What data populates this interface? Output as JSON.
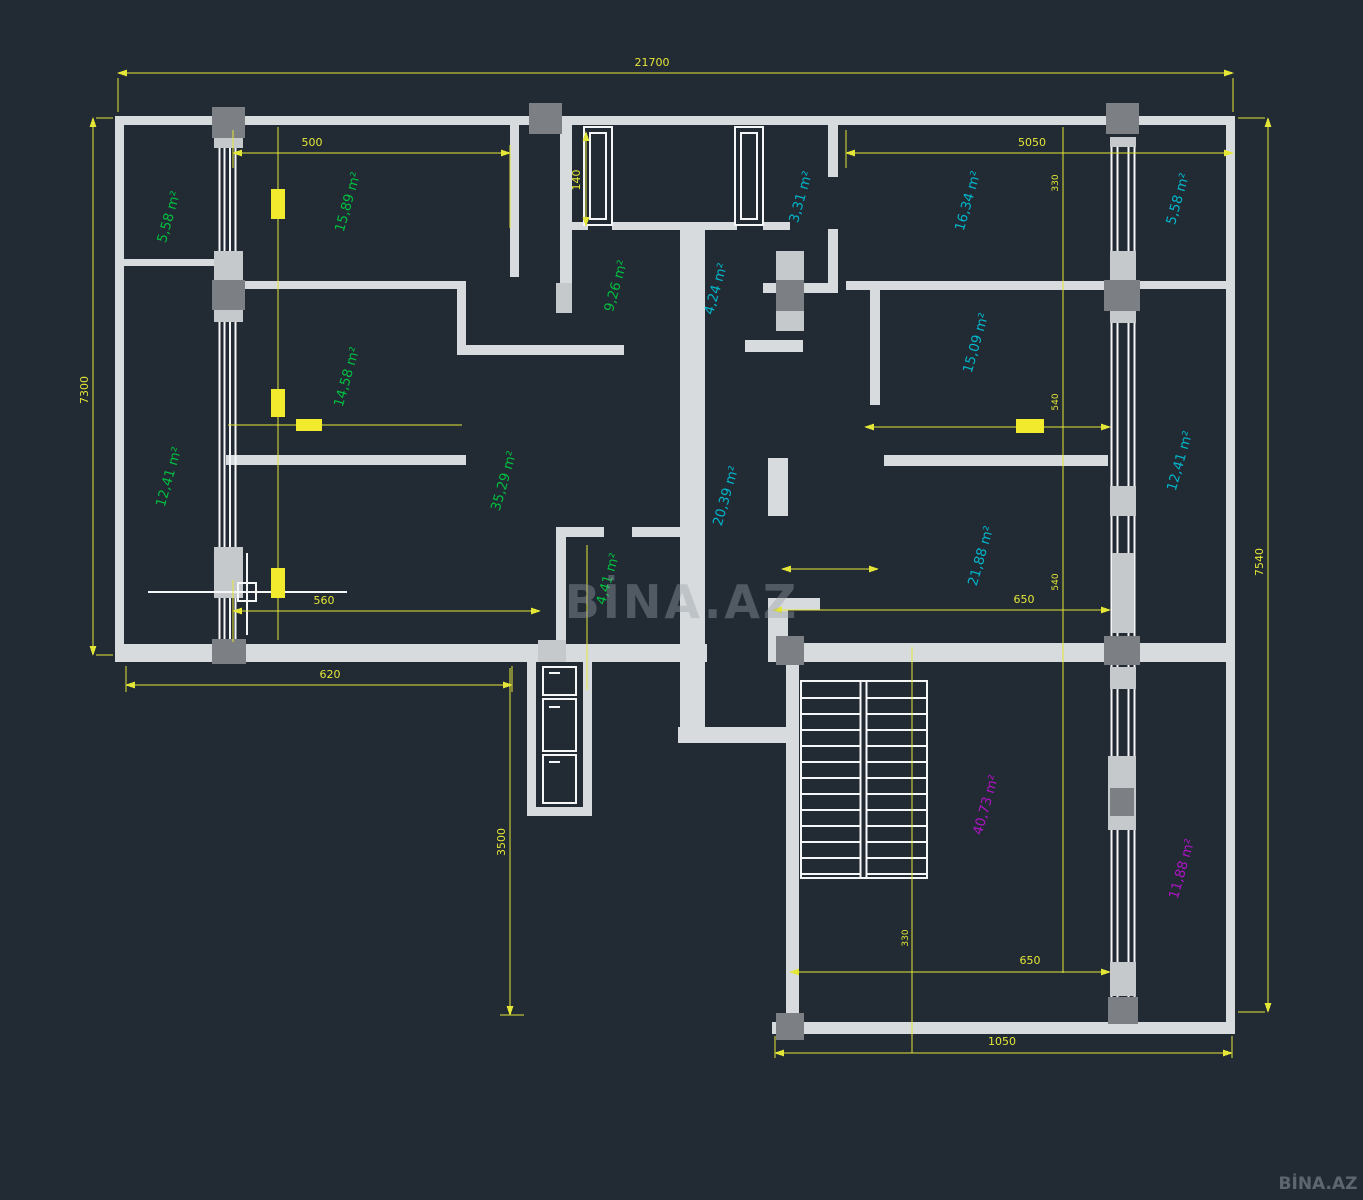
{
  "title": "Apartment floor plan (CAD drawing)",
  "colors": {
    "background": "#222a34",
    "wall": "#d8dbde",
    "wall_bright": "#f5f6f7",
    "column_dark": "#7c8085",
    "column_light": "#c6c9cc",
    "dimension": "#e4e637",
    "door": "#f2ea2c",
    "green": "#00bf3f",
    "cyan": "#00b6cb",
    "magenta": "#ae13c4",
    "watermark": "#99a0a9"
  },
  "watermark": {
    "center": "BİNA.AZ",
    "corner": "BİNA.AZ"
  },
  "rooms": [
    {
      "id": "balcony-left-top",
      "label": "5,58 m²",
      "color": "green"
    },
    {
      "id": "bedroom-left-top",
      "label": "15,89 m²",
      "color": "green"
    },
    {
      "id": "bedroom-left-mid",
      "label": "14,58 m²",
      "color": "green"
    },
    {
      "id": "balcony-left-bottom",
      "label": "12,41 m²",
      "color": "green"
    },
    {
      "id": "hall-left",
      "label": "9,26 m²",
      "color": "green"
    },
    {
      "id": "living-left",
      "label": "35,29 m²",
      "color": "green"
    },
    {
      "id": "bath-left",
      "label": "4,41 m²",
      "color": "green"
    },
    {
      "id": "vestibule",
      "label": "4,24 m²",
      "color": "cyan"
    },
    {
      "id": "wc-entry",
      "label": "3,31 m²",
      "color": "cyan"
    },
    {
      "id": "bedroom-right-top",
      "label": "16,34 m²",
      "color": "cyan"
    },
    {
      "id": "balcony-right-top",
      "label": "5,58 m²",
      "color": "cyan"
    },
    {
      "id": "bedroom-right-mid",
      "label": "15,09 m²",
      "color": "cyan"
    },
    {
      "id": "balcony-right-mid",
      "label": "12,41 m²",
      "color": "cyan"
    },
    {
      "id": "corridor",
      "label": "20,39 m²",
      "color": "cyan"
    },
    {
      "id": "living-right",
      "label": "21,88 m²",
      "color": "cyan"
    },
    {
      "id": "stair-hall",
      "label": "40,73 m²",
      "color": "magenta"
    },
    {
      "id": "balcony-right-bottom",
      "label": "11,88 m²",
      "color": "magenta"
    }
  ],
  "dimensions": [
    {
      "id": "overall-width",
      "label": "21700"
    },
    {
      "id": "left-height",
      "label": "7300"
    },
    {
      "id": "right-height",
      "label": "7540"
    },
    {
      "id": "elevator-drop",
      "label": "3500"
    },
    {
      "id": "room-top-left-width",
      "label": "500"
    },
    {
      "id": "entry-door-width",
      "label": "140"
    },
    {
      "id": "right-top-width",
      "label": "5050"
    },
    {
      "id": "tick-330-top",
      "label": "330"
    },
    {
      "id": "tick-540-upper",
      "label": "540"
    },
    {
      "id": "tick-540-lower",
      "label": "540"
    },
    {
      "id": "living-right-width",
      "label": "650"
    },
    {
      "id": "left-bottom-width",
      "label": "560"
    },
    {
      "id": "left-bottom-outer",
      "label": "620"
    },
    {
      "id": "stair-width",
      "label": "650"
    },
    {
      "id": "wing-width",
      "label": "1050"
    },
    {
      "id": "tick-330-stair",
      "label": "330"
    }
  ]
}
